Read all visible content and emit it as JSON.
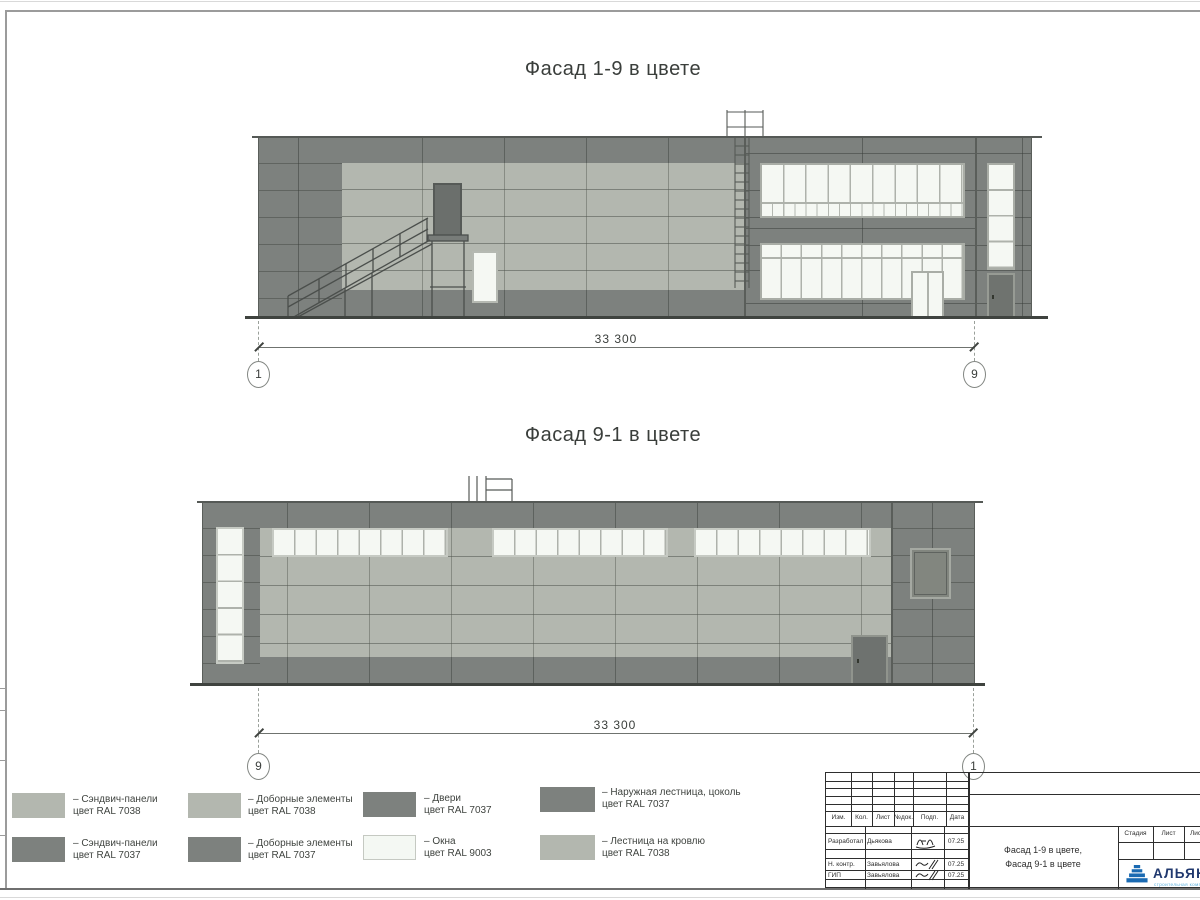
{
  "sheet": {
    "titles": {
      "facade1": "Фасад 1-9 в цвете",
      "facade2": "Фасад 9-1 в цвете"
    }
  },
  "facade1": {
    "dim": "33 300",
    "grid_left": "1",
    "grid_right": "9"
  },
  "facade2": {
    "dim": "33 300",
    "grid_left": "9",
    "grid_right": "1"
  },
  "legend": {
    "items": [
      {
        "color": "#b3b7af",
        "line1": "– Сэндвич-панели",
        "line2": "цвет RAL 7038"
      },
      {
        "color": "#7d817e",
        "line1": "– Сэндвич-панели",
        "line2": "цвет RAL 7037"
      },
      {
        "color": "#b3b7af",
        "line1": "– Доборные элементы",
        "line2": "цвет RAL 7038"
      },
      {
        "color": "#7d817e",
        "line1": "– Доборные элементы",
        "line2": "цвет RAL 7037"
      },
      {
        "color": "#7d817e",
        "line1": "– Двери",
        "line2": "цвет RAL 7037"
      },
      {
        "color": "#f4f8f3",
        "line1": "– Окна",
        "line2": "цвет RAL 9003"
      },
      {
        "color": "#7d817e",
        "line1": "– Наружная лестница, цоколь",
        "line2": "цвет RAL 7037"
      },
      {
        "color": "#b3b7af",
        "line1": "– Лестница на кровлю",
        "line2": "цвет RAL 7038"
      }
    ]
  },
  "titleblock": {
    "cols": [
      "Изм.",
      "Кол.",
      "Лист",
      "№док.",
      "Подп.",
      "Дата"
    ],
    "rows": [
      {
        "role": "Разработал",
        "name": "Дьякова",
        "date": "07.25"
      },
      {
        "role": "Н. контр.",
        "name": "Завьялова",
        "date": "07.25"
      },
      {
        "role": "ГИП",
        "name": "Завьялова",
        "date": "07.25"
      }
    ],
    "stage_cols": [
      "Стадия",
      "Лист",
      "Листов"
    ],
    "title_line1": "Фасад 1-9 в цвете,",
    "title_line2": "Фасад 9-1 в цвете",
    "logo": {
      "name": "АЛЬЯНС",
      "tagline": "строительная компания"
    }
  }
}
